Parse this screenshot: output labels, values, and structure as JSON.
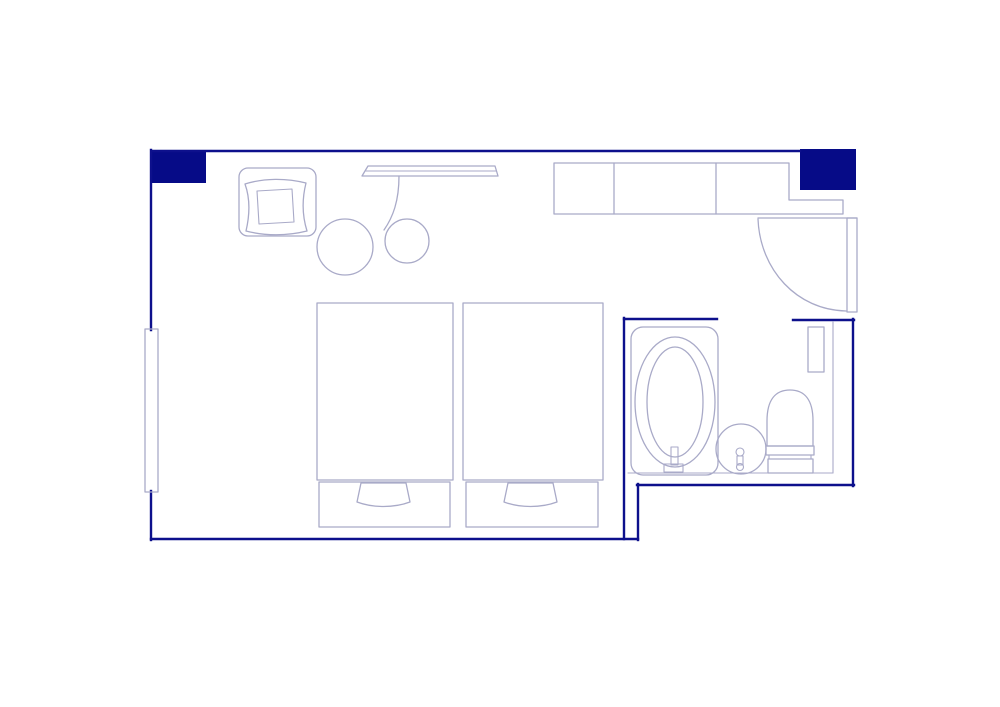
{
  "page": {
    "kind": "floor-plan-image",
    "background": "#ffffff"
  },
  "colors": {
    "wall": "#0d108c",
    "wall_fill": "#060b87",
    "furniture": "#a9aac8"
  },
  "plan": {
    "rooms": [
      "bedroom",
      "bathroom"
    ],
    "furniture_symbols": [
      "armchair",
      "armchair-cushion",
      "round-table",
      "round-stool",
      "desk",
      "wardrobe-counter",
      "entry-door",
      "window",
      "twin-bed-left",
      "twin-bed-right",
      "bed-pillow",
      "bathtub",
      "bath-faucet",
      "washbasin",
      "basin-faucet",
      "toilet",
      "bathroom-shelf",
      "wall-pillar"
    ]
  }
}
